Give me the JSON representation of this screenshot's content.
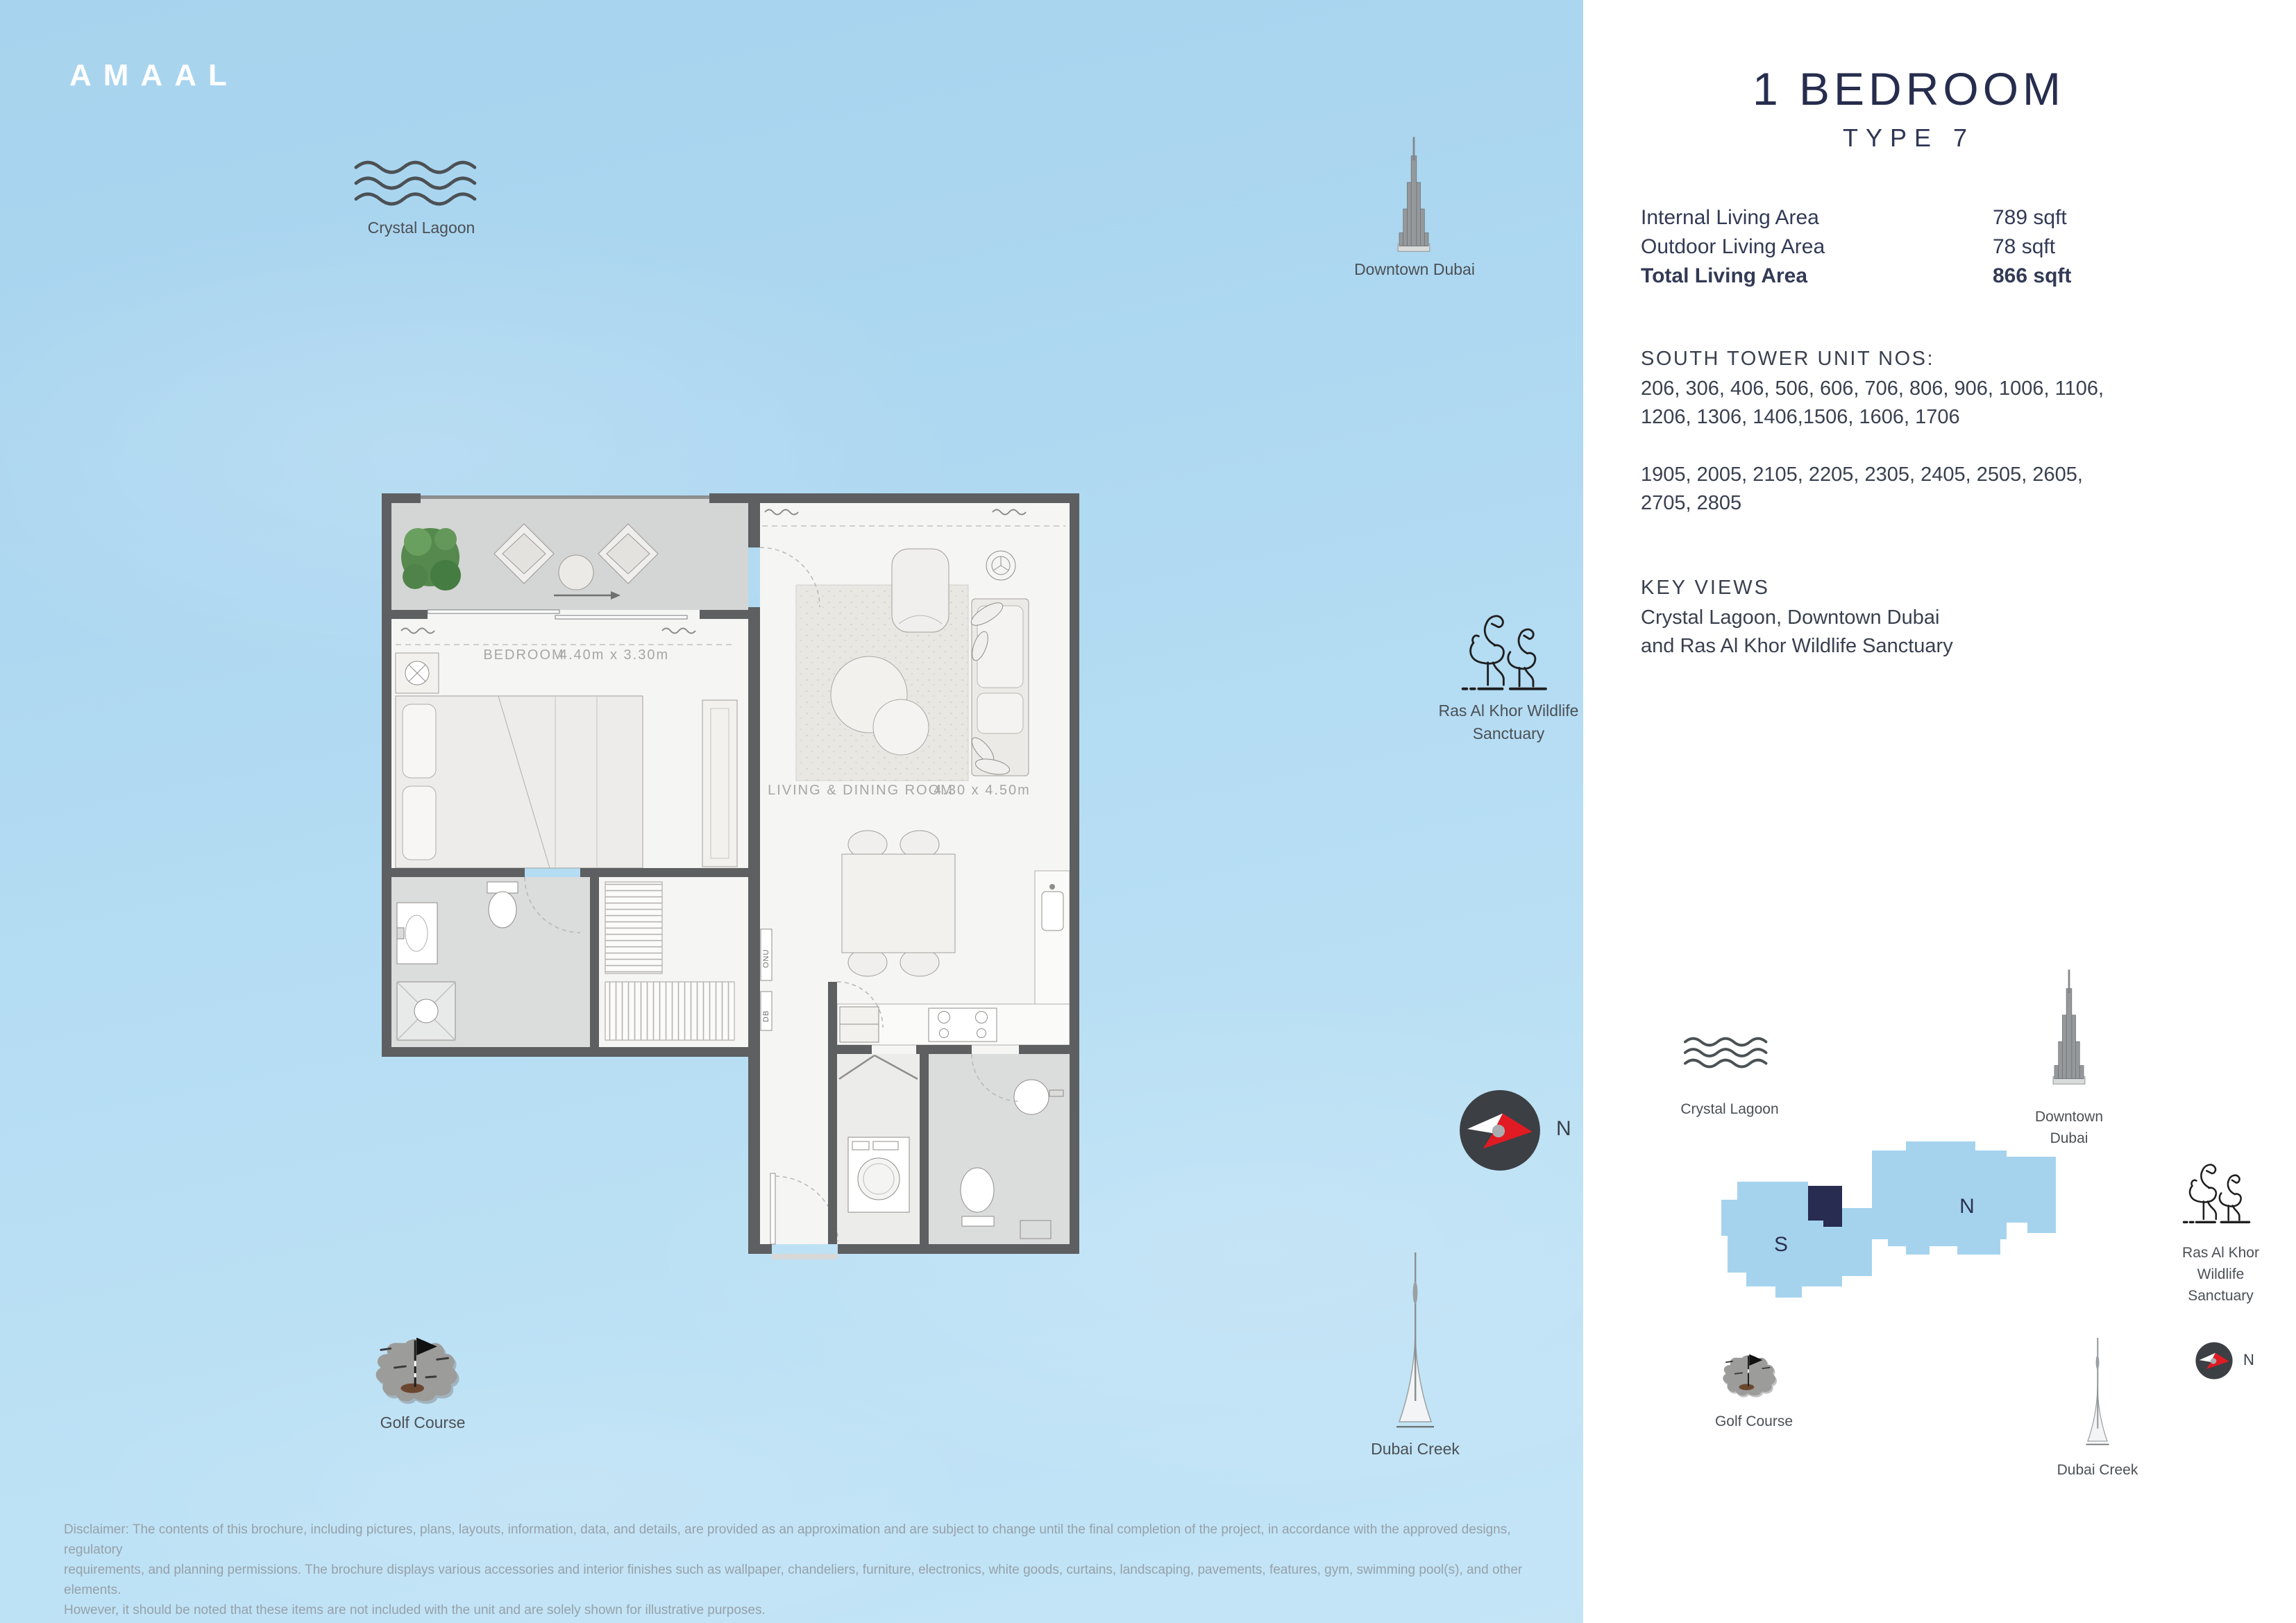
{
  "logo": "AMAAL",
  "panel": {
    "title": "1 BEDROOM",
    "subtitle": "TYPE 7",
    "areas": [
      {
        "label": "Internal Living Area",
        "value": "789 sqft"
      },
      {
        "label": "Outdoor Living Area",
        "value": "78 sqft"
      },
      {
        "label": "Total Living Area",
        "value": "866 sqft"
      }
    ],
    "units_heading": "SOUTH TOWER UNIT NOS:",
    "units_lines": [
      "206, 306, 406, 506, 606, 706, 806, 906, 1006, 1106,",
      "1206, 1306, 1406,1506, 1606, 1706"
    ],
    "units_lines2": [
      "1905, 2005, 2105, 2205, 2305, 2405, 2505, 2605,",
      "2705, 2805"
    ],
    "key_views_heading": "KEY VIEWS",
    "key_views_lines": [
      "Crystal Lagoon, Downtown Dubai",
      "and Ras Al Khor Wildlife Sanctuary"
    ]
  },
  "landmarks": {
    "crystal_lagoon": "Crystal Lagoon",
    "downtown_dubai": "Downtown Dubai",
    "downtown_line1": "Downtown",
    "downtown_line2": "Dubai",
    "ras_line1": "Ras Al Khor Wildlife",
    "ras_line2": "Sanctuary",
    "ras_sm_line1": "Ras Al Khor",
    "ras_sm_line2": "Wildlife",
    "ras_sm_line3": "Sanctuary",
    "golf_course": "Golf Course",
    "dubai_creek": "Dubai Creek"
  },
  "compass": {
    "north": "N"
  },
  "sitemap": {
    "south_label": "S",
    "north_label": "N"
  },
  "floorplan": {
    "bedroom_label": "BEDROOM",
    "bedroom_dims": "4.40m x 3.30m",
    "living_label": "LIVING & DINING ROOM",
    "living_dims": "4.30 x 4.50m",
    "closet_onu": "ONU",
    "closet_db": "DB"
  },
  "disclaimer": {
    "line1": "Disclaimer: The contents of this brochure, including pictures, plans, layouts, information, data, and details, are provided as an approximation and are subject to change until the final completion of the project, in accordance with the approved designs, regulatory",
    "line2": "requirements, and planning permissions. The brochure displays various accessories and interior finishes such as wallpaper, chandeliers, furniture, electronics, white goods, curtains, landscaping, pavements, features, gym, swimming pool(s), and other elements.",
    "line3": "However, it should be noted that these items are not included with the unit and are solely shown for illustrative purposes."
  },
  "colors": {
    "sky": "#aed8f1",
    "panel_bg": "#ffffff",
    "navy_text": "#262d4d",
    "body_text": "#39404f",
    "wall_gray": "#5d5f61",
    "tower_blue": "#a5d3ee",
    "unit_marker_navy": "#272c50",
    "compass_red": "#e01b24",
    "compass_dark": "#3c3f43"
  }
}
